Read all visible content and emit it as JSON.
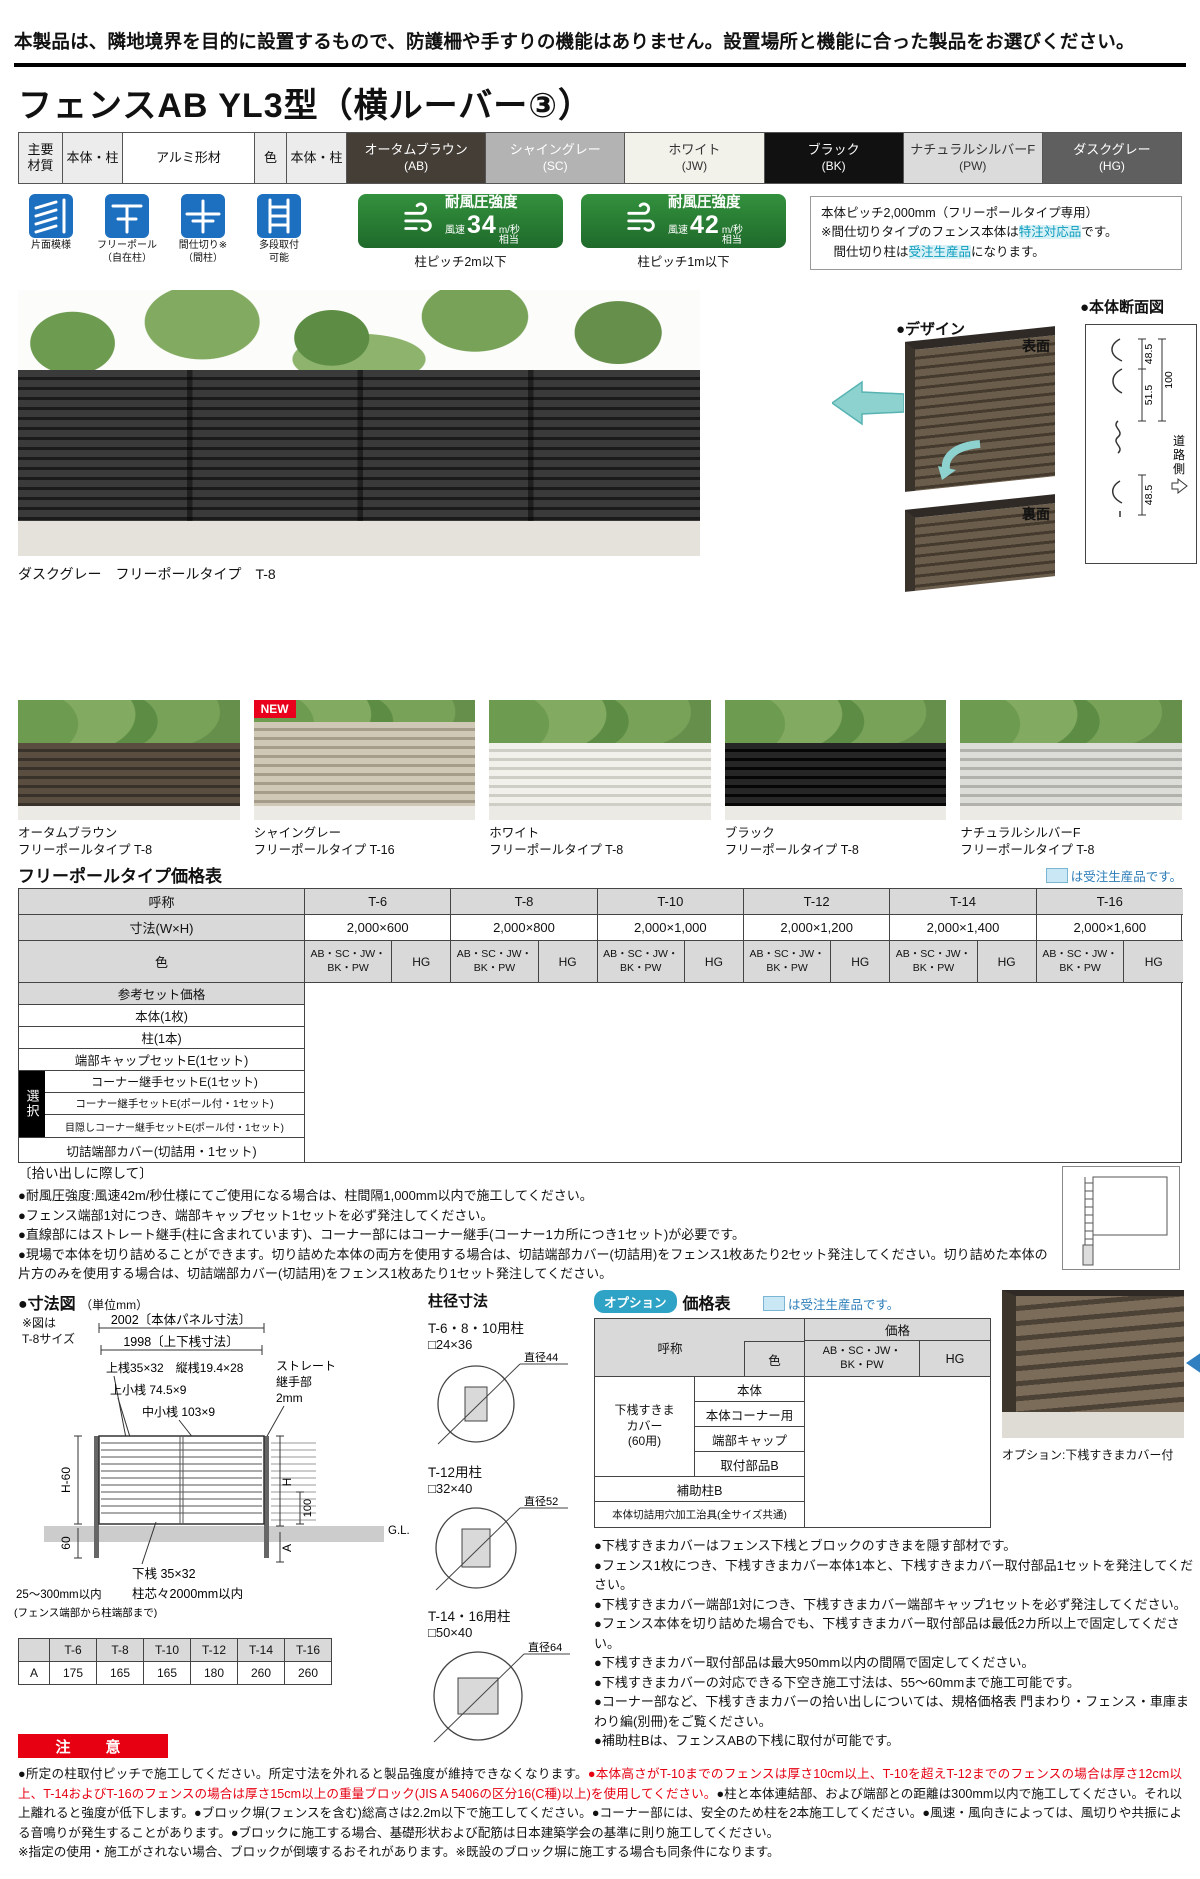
{
  "notice": "本製品は、隣地境界を目的に設置するもので、防護柵や手すりの機能はありません。設置場所と機能に合った製品をお選びください。",
  "title": "フェンスAB YL3型（横ルーバー③）",
  "materials": {
    "main1": "主要",
    "main2": "材質",
    "body_post1": "本体・柱",
    "material": "アルミ形材",
    "color_label": "色",
    "body_post2": "本体・柱",
    "colors": [
      {
        "name": "オータムブラウン",
        "code": "(AB)",
        "style": "background:#453e36;color:#ffffff"
      },
      {
        "name": "シャイングレー",
        "code": "(SC)",
        "style": "background:#b3b3b3;color:#ffffff"
      },
      {
        "name": "ホワイト",
        "code": "(JW)",
        "style": "background:#f2f1ea;color:#333333"
      },
      {
        "name": "ブラック",
        "code": "(BK)",
        "style": "background:#111111;color:#ffffff"
      },
      {
        "name": "ナチュラルシルバーF",
        "code": "(PW)",
        "style": "background:#dbdbdb;color:#333333"
      },
      {
        "name": "ダスクグレー",
        "code": "(HG)",
        "style": "background:#5f5f5f;color:#ffffff"
      }
    ]
  },
  "features": {
    "icons": [
      {
        "line1": "片面模様",
        "line2": ""
      },
      {
        "line1": "フリーポール",
        "line2": "（自在柱）"
      },
      {
        "line1": "間仕切り※",
        "line2": "（間柱）"
      },
      {
        "line1": "多段取付",
        "line2": "可能"
      }
    ],
    "wind": [
      {
        "title": "耐風圧強度",
        "pre": "風速",
        "num": "34",
        "unit": "m/秒",
        "post": "相当",
        "caption": "柱ピッチ2m以下"
      },
      {
        "title": "耐風圧強度",
        "pre": "風速",
        "num": "42",
        "unit": "m/秒",
        "post": "相当",
        "caption": "柱ピッチ1m以下"
      }
    ],
    "info": {
      "line1": "本体ピッチ2,000mm（フリーポールタイプ専用）",
      "line2_pre": "※間仕切りタイプのフェンス本体は",
      "line2_hl": "特注対応品",
      "line2_post": "です。",
      "line3_pre": "　間仕切り柱は",
      "line3_hl": "受注生産品",
      "line3_post": "になります。"
    }
  },
  "design": {
    "title": "●デザイン",
    "front": "表面",
    "back": "裏面"
  },
  "section_view": {
    "title": "●本体断面図",
    "d1": "48.5",
    "d2": "100",
    "d3": "51.5",
    "d4": "48.5",
    "side1": "道",
    "side2": "路",
    "side3": "側"
  },
  "main_photo": {
    "caption": "ダスクグレー　フリーポールタイプ　T-8",
    "fence_style": "background:repeating-linear-gradient(180deg,#3a3a3a 0 7px,#1b1b1b 7px 10px)"
  },
  "variants": {
    "new_badge": "NEW",
    "items": [
      {
        "name": "オータムブラウン",
        "type": "フリーポールタイプ T-8",
        "style": "background:repeating-linear-gradient(180deg,#5a4e40 0 6px,#39322a 6px 9px)"
      },
      {
        "name": "シャイングレー",
        "type": "フリーポールタイプ T-16",
        "style": "background:repeating-linear-gradient(180deg,#cfc8b6 0 6px,#a59d89 6px 9px);top:18%"
      },
      {
        "name": "ホワイト",
        "type": "フリーポールタイプ T-8",
        "style": "background:repeating-linear-gradient(180deg,#f1f0ea 0 6px,#cfcec6 6px 9px)"
      },
      {
        "name": "ブラック",
        "type": "フリーポールタイプ T-8",
        "style": "background:repeating-linear-gradient(180deg,#262626 0 6px,#060606 6px 9px)"
      },
      {
        "name": "ナチュラルシルバーF",
        "type": "フリーポールタイプ T-8",
        "style": "background:repeating-linear-gradient(180deg,#dcdcd8 0 6px,#b2b2ad 6px 9px)"
      }
    ]
  },
  "price_table": {
    "title": "フリーポールタイプ価格表",
    "legend": "は受注生産品です。",
    "name_h": "呼称",
    "size_h": "寸法(W×H)",
    "color_h": "色",
    "cols": [
      {
        "name": "T-6",
        "size": "2,000×600"
      },
      {
        "name": "T-8",
        "size": "2,000×800"
      },
      {
        "name": "T-10",
        "size": "2,000×1,000"
      },
      {
        "name": "T-12",
        "size": "2,000×1,200"
      },
      {
        "name": "T-14",
        "size": "2,000×1,400"
      },
      {
        "name": "T-16",
        "size": "2,000×1,600"
      }
    ],
    "grp1a": "AB・SC・JW・",
    "grp1b": "BK・PW",
    "grp2": "HG",
    "row_set": "参考セット価格",
    "row1": "本体(1枚)",
    "row2": "柱(1本)",
    "row3": "端部キャップセットE(1セット)",
    "select": "選択",
    "sel1": "コーナー継手セットE(1セット)",
    "sel2": "コーナー継手セットE(ポール付・1セット)",
    "sel3": "目隠しコーナー継手セットE(ポール付・1セット)",
    "row_last": "切詰端部カバー(切詰用・1セット)"
  },
  "pickup": {
    "title": "〔拾い出しに際して〕",
    "b1": "●耐風圧強度:風速42m/秒仕様にてご使用になる場合は、柱間隔1,000mm以内で施工してください。",
    "b2": "●フェンス端部1対につき、端部キャップセット1セットを必ず発注してください。",
    "b3": "●直線部にはストレート継手(柱に含まれています)、コーナー部にはコーナー継手(コーナー1カ所につき1セット)が必要です。",
    "b4": "●現場で本体を切り詰めることができます。切り詰めた本体の両方を使用する場合は、切詰端部カバー(切詰用)をフェンス1枚あたり2セット発注してください。切り詰めた本体の片方のみを使用する場合は、切詰端部カバー(切詰用)をフェンス1枚あたり1セット発注してください。"
  },
  "dim": {
    "title": "●寸法図",
    "unit": "（単位mm）",
    "note1": "※図は",
    "note2": "T-8サイズ",
    "panel": "2002〔本体パネル寸法〕",
    "rail": "1998〔上下桟寸法〕",
    "l1": "上桟35×32　縦桟19.4×28",
    "l2": "上小桟 74.5×9",
    "l3": "中小桟 103×9",
    "j1": "ストレート",
    "j2": "継手部",
    "j3": "2mm",
    "h60": "H-60",
    "s60": "60",
    "h": "H",
    "n100": "100",
    "gl": "G.L.",
    "a": "A",
    "bottom": "下桟 35×32",
    "pitch": "柱芯々2000mm以内",
    "range": "25～300mm以内",
    "range2": "(フェンス端部から柱端部まで)"
  },
  "posts": {
    "title": "柱径寸法",
    "items": [
      {
        "name": "T-6・8・10用柱",
        "size": "□24×36",
        "dia": "直径44"
      },
      {
        "name": "T-12用柱",
        "size": "□32×40",
        "dia": "直径52"
      },
      {
        "name": "T-14・16用柱",
        "size": "□50×40",
        "dia": "直径64"
      }
    ]
  },
  "a_table": {
    "cols": [
      "T-6",
      "T-8",
      "T-10",
      "T-12",
      "T-14",
      "T-16"
    ],
    "label": "A",
    "vals": [
      "175",
      "165",
      "165",
      "180",
      "260",
      "260"
    ]
  },
  "option": {
    "badge": "オプション",
    "title": "価格表",
    "legend": "は受注生産品です。",
    "name_h": "呼称",
    "color_h": "色",
    "price_h": "価格",
    "grp1a": "AB・SC・JW・",
    "grp1b": "BK・PW",
    "grp2": "HG",
    "g_l1": "下桟すきま",
    "g_l2": "カバー",
    "g_l3": "(60用)",
    "r1": "本体",
    "r2": "本体コーナー用",
    "r3": "端部キャップ",
    "r4": "取付部品B",
    "r5": "補助柱B",
    "r6": "本体切詰用穴加工治具(全サイズ共通)",
    "photo_caption": "オプション:下桟すきまカバー付",
    "notes": [
      "●下桟すきまカバーはフェンス下桟とブロックのすきまを隠す部材です。",
      "●フェンス1枚につき、下桟すきまカバー本体1本と、下桟すきまカバー取付部品1セットを発注してください。",
      "●下桟すきまカバー端部1対につき、下桟すきまカバー端部キャップ1セットを必ず発注してください。",
      "●フェンス本体を切り詰めた場合でも、下桟すきまカバー取付部品は最低2カ所以上で固定してください。",
      "●下桟すきまカバー取付部品は最大950mm以内の間隔で固定してください。",
      "●下桟すきまカバーの対応できる下空き施工寸法は、55～60mmまで施工可能です。",
      "●コーナー部など、下桟すきまカバーの拾い出しについては、規格価格表 門まわり・フェンス・車庫まわり編(別冊)をご覧ください。",
      "●補助柱Bは、フェンスABの下桟に取付が可能です。"
    ]
  },
  "caution": {
    "badge": "注　意",
    "t1": "●所定の柱取付ピッチで施工してください。所定寸法を外れると製品強度が維持できなくなります。",
    "t2": "●本体高さがT-10までのフェンスは厚さ10cm以上、T-10を超えT-12までのフェンスの場合は厚さ12cm以上、T-14およびT-16のフェンスの場合は厚さ15cm以上の重量ブロック(JIS A 5406の区分16(C種)以上)を使用してください。",
    "t3": "●柱と本体連結部、および端部との距離は300mm以内で施工してください。それ以上離れると強度が低下します。●ブロック塀(フェンスを含む)総高さは2.2m以下で施工してください。●コーナー部には、安全のため柱を2本施工してください。●風速・風向きによっては、風切りや共振による音鳴りが発生することがあります。●ブロックに施工する場合、基礎形状および配筋は日本建築学会の基準に則り施工してください。",
    "t4": "※指定の使用・施工がされない場合、ブロックが倒壊するおそれがあります。※既設のブロック塀に施工する場合も同条件になります。"
  }
}
